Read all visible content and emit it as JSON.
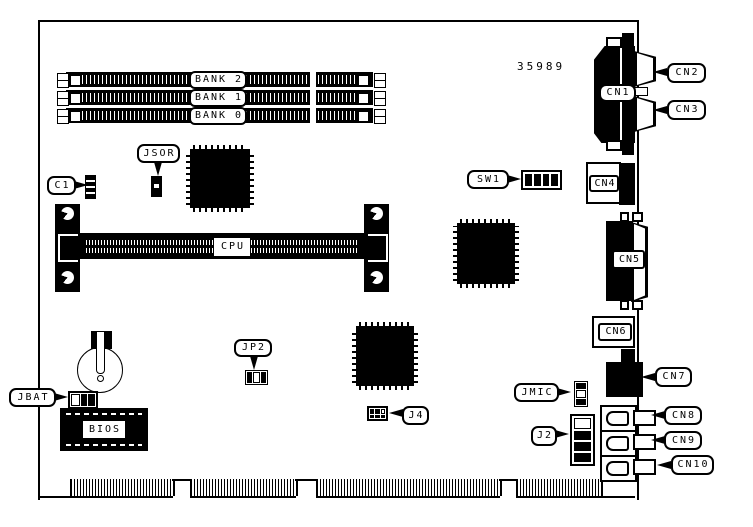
{
  "diagram": {
    "part_number": "35989",
    "labels": {
      "bank2": "BANK 2",
      "bank1": "BANK 1",
      "bank0": "BANK 0",
      "jsor": "JSOR",
      "c1": "C1",
      "cpu": "CPU",
      "sw1": "SW1",
      "cn1": "CN1",
      "cn2": "CN2",
      "cn3": "CN3",
      "cn4": "CN4",
      "cn5": "CN5",
      "cn6": "CN6",
      "cn7": "CN7",
      "cn8": "CN8",
      "cn9": "CN9",
      "cn10": "CN10",
      "jmic": "JMIC",
      "j2": "J2",
      "j4": "J4",
      "jp2": "JP2",
      "jbat": "JBAT",
      "bios": "BIOS"
    },
    "colors": {
      "ink": "#000000",
      "background": "#ffffff"
    }
  }
}
